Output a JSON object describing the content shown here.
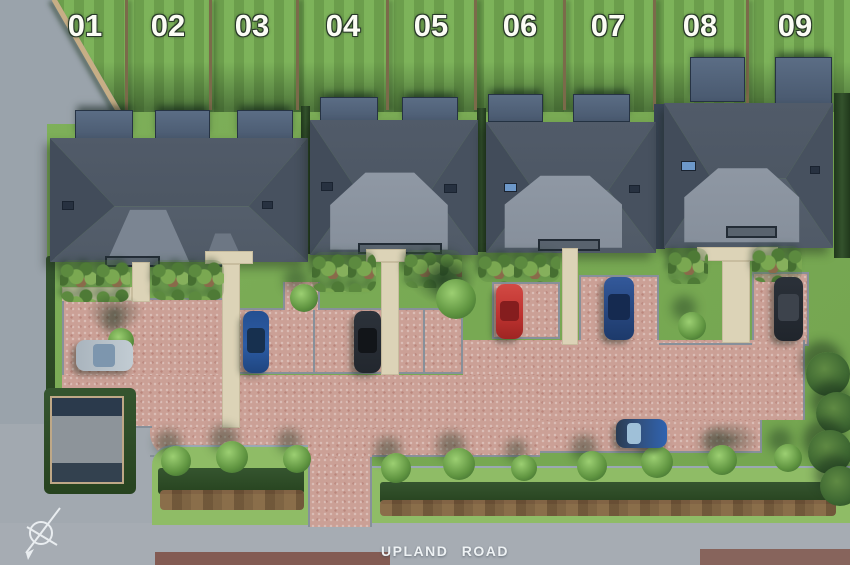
{
  "plots": {
    "labels": [
      "01",
      "02",
      "03",
      "04",
      "05",
      "06",
      "07",
      "08",
      "09"
    ]
  },
  "road": {
    "label": "UPLAND ROAD"
  },
  "compass": {
    "icon": "north-arrow"
  },
  "scene": {
    "type": "residential-development-site-plan",
    "houses_count": 4,
    "cars": [
      {
        "color_name": "silver-blue",
        "hex": "#b7c1c9",
        "orientation": "horizontal"
      },
      {
        "color_name": "blue",
        "hex": "#2c5ca5",
        "orientation": "vertical"
      },
      {
        "color_name": "black",
        "hex": "#272c33",
        "orientation": "vertical"
      },
      {
        "color_name": "red",
        "hex": "#bf3330",
        "orientation": "vertical"
      },
      {
        "color_name": "dark-blue",
        "hex": "#27477f",
        "orientation": "vertical"
      },
      {
        "color_name": "black",
        "hex": "#262b32",
        "orientation": "vertical"
      },
      {
        "color_name": "blue",
        "hex": "#31507e",
        "orientation": "horizontal"
      }
    ],
    "palette": {
      "roof_dark": "#4c5664",
      "roof_light": "#8d96a2",
      "paving_pink": "#cba096",
      "grass": "#7cae58",
      "lawn_stripe_light": "#7db35a",
      "lawn_stripe_dark": "#6c9e4c",
      "road_grey": "#9aa3ab",
      "hedge_green": "#2f4d2b",
      "path_beige": "#dcd3b7"
    }
  }
}
